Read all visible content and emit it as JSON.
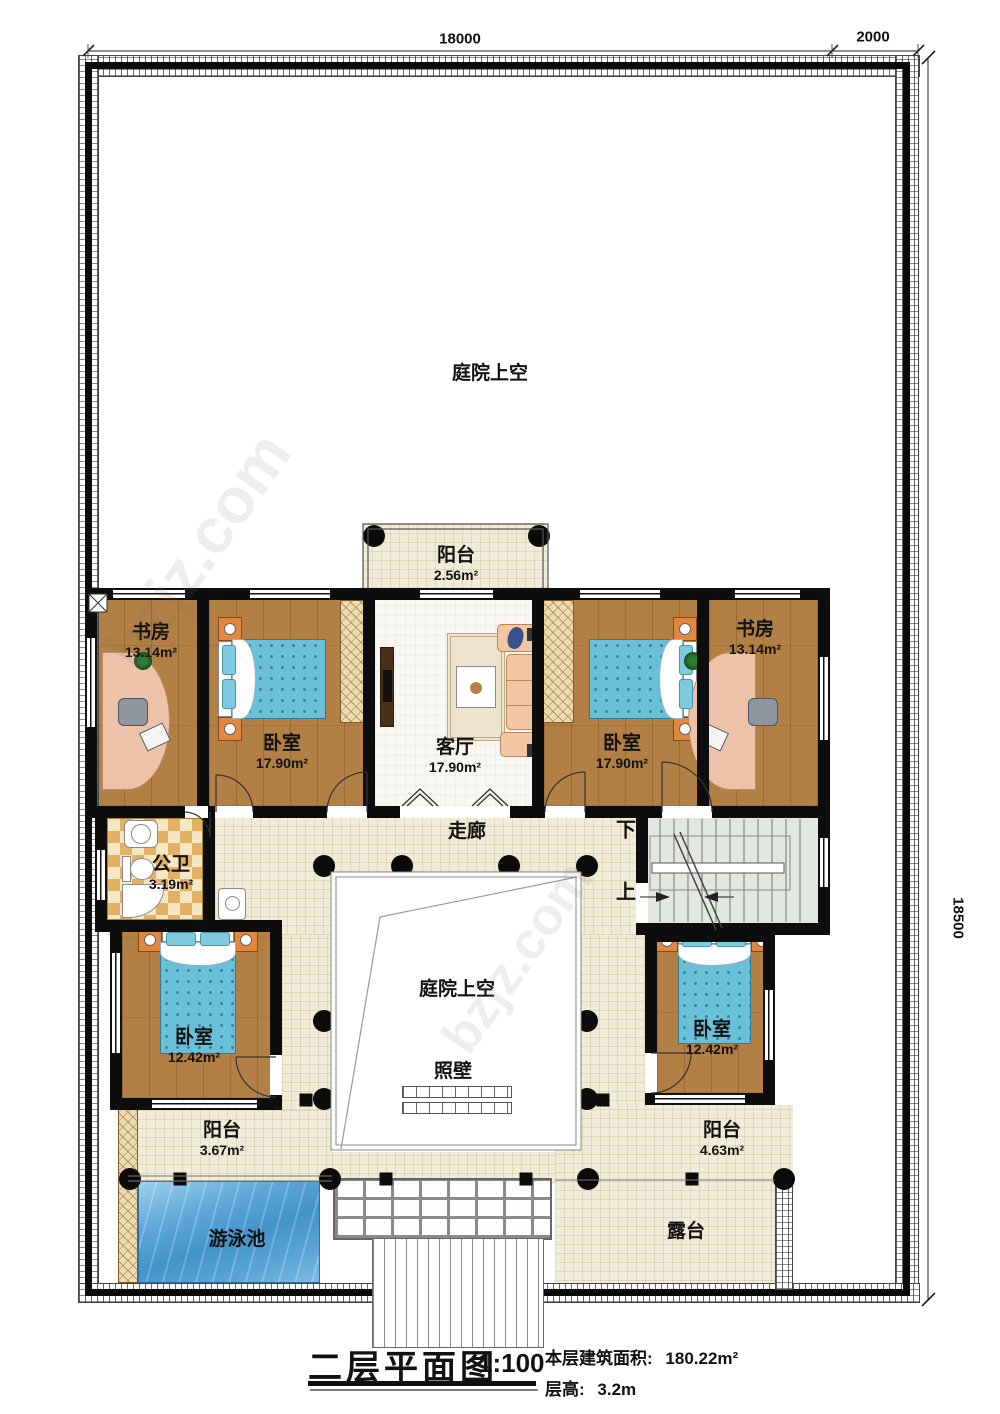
{
  "dimensions": {
    "top_width": "18000",
    "top_right_width": "2000",
    "right_height": "18500"
  },
  "labels": {
    "courtyard_top": "庭院上空",
    "courtyard_center": "庭院上空",
    "corridor": "走廊",
    "screen_wall": "照壁",
    "pool": "游泳池",
    "terrace": "露台",
    "stair_down": "下",
    "stair_up": "上"
  },
  "rooms": {
    "balcony_top": {
      "name": "阳台",
      "area": "2.56m²"
    },
    "study_left": {
      "name": "书房",
      "area": "13.14m²"
    },
    "bedroom_top_left": {
      "name": "卧室",
      "area": "17.90m²"
    },
    "living_room": {
      "name": "客厅",
      "area": "17.90m²"
    },
    "bedroom_top_right": {
      "name": "卧室",
      "area": "17.90m²"
    },
    "study_right": {
      "name": "书房",
      "area": "13.14m²"
    },
    "bathroom": {
      "name": "公卫",
      "area": "3.19m²"
    },
    "bedroom_bottom_left": {
      "name": "卧室",
      "area": "12.42m²"
    },
    "bedroom_bottom_right": {
      "name": "卧室",
      "area": "12.42m²"
    },
    "balcony_left": {
      "name": "阳台",
      "area": "3.67m²"
    },
    "balcony_right": {
      "name": "阳台",
      "area": "4.63m²"
    }
  },
  "title_block": {
    "title": "二层平面图",
    "scale": "1:100",
    "area_label": "本层建筑面积:",
    "area_value": "180.22m²",
    "floor_height_label": "层高:",
    "floor_height_value": "3.2m"
  },
  "watermark": {
    "text": "bzjz.com"
  }
}
